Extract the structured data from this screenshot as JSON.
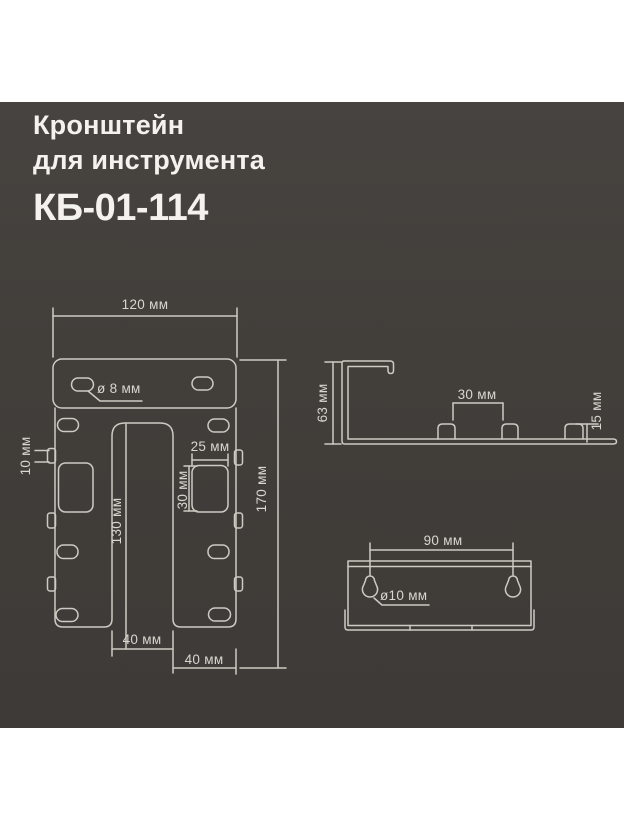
{
  "title": {
    "line1": "Кронштейн",
    "line2": "для инструмента",
    "model": "КБ-01-114"
  },
  "front_view": {
    "width": "120 мм",
    "hole": "ø 8 мм",
    "tab": "10 мм",
    "slot_w": "25 мм",
    "slot_h": "30 мм",
    "inner": "130 мм",
    "total": "170 мм",
    "gap": "40 мм",
    "leg": "40 мм"
  },
  "side_view": {
    "height": "63 мм",
    "spacing": "30 мм",
    "tab": "15 мм"
  },
  "back_view": {
    "spacing": "90 мм",
    "hole": "ø10 мм"
  },
  "colors": {
    "page_bg": "#ffffff",
    "panel_bg": "#433f3b",
    "line": "#d6d2cb",
    "dim_text": "#d9d5cf",
    "title_text": "#f4f2ee"
  }
}
